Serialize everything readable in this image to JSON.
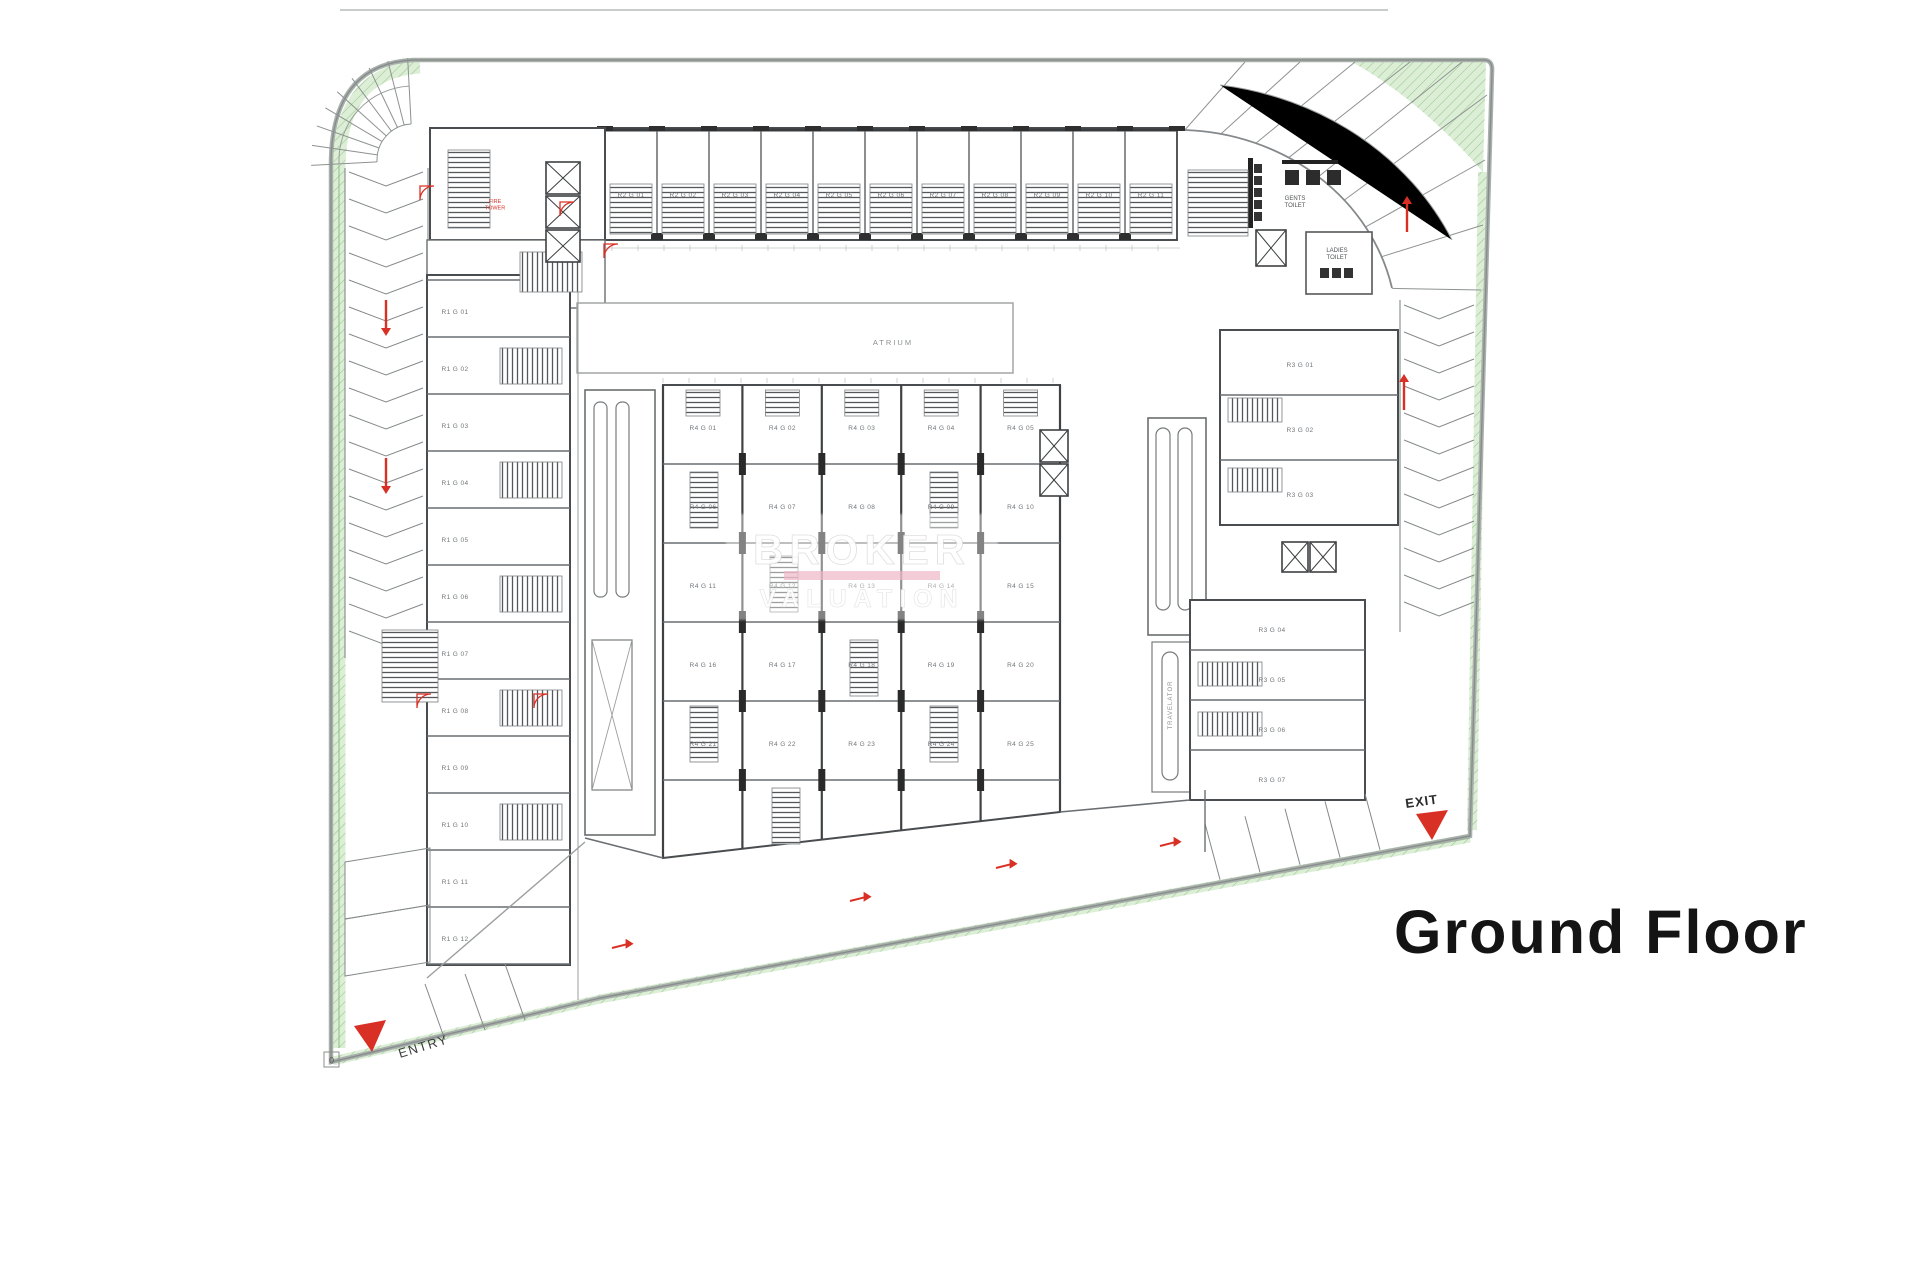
{
  "title": "Ground Floor",
  "labels": {
    "entry": "ENTRY",
    "exit": "EXIT",
    "atrium": "ATRIUM",
    "gents_toilet": "GENTS TOILET",
    "ladies_toilet": "LADIES TOILET",
    "fire_tower": "FIRE TOWER",
    "travelator": "TRAVELATOR",
    "origin_marker": "0"
  },
  "watermark": {
    "line1": "BROKER",
    "line2": "VALUATION"
  },
  "colors": {
    "green_fill": "#dcefd6",
    "green_line": "#8dbd84",
    "boundary": "#aab1ad",
    "boundary_dark": "#878d8a",
    "wall": "#4a4d4f",
    "red": "#d93025",
    "unit_text": "#71767a",
    "title_text": "#141414"
  },
  "units": {
    "top_row": [
      "R2 G 01",
      "R2 G 02",
      "R2 G 03",
      "R2 G 04",
      "R2 G 05",
      "R2 G 06",
      "R2 G 07",
      "R2 G 08",
      "R2 G 09",
      "R2 G 10",
      "R2 G 11"
    ],
    "left_column": [
      "R1 G 01",
      "R1 G 02",
      "R1 G 03",
      "R1 G 04",
      "R1 G 05",
      "R1 G 06",
      "R1 G 07",
      "R1 G 08",
      "R1 G 09",
      "R1 G 10",
      "R1 G 11",
      "R1 G 12"
    ],
    "right_upper": [
      "R3 G 01",
      "R3 G 02",
      "R3 G 03"
    ],
    "right_lower": [
      "R3 G 04",
      "R3 G 05",
      "R3 G 06",
      "R3 G 07"
    ],
    "center_grid": [
      "R4 G 01",
      "R4 G 02",
      "R4 G 03",
      "R4 G 04",
      "R4 G 05",
      "R4 G 06",
      "R4 G 07",
      "R4 G 08",
      "R4 G 09",
      "R4 G 10",
      "R4 G 11",
      "R4 G 12",
      "R4 G 13",
      "R4 G 14",
      "R4 G 15",
      "R4 G 16",
      "R4 G 17",
      "R4 G 18",
      "R4 G 19",
      "R4 G 20",
      "R4 G 21",
      "R4 G 22",
      "R4 G 23",
      "R4 G 24",
      "R4 G 25"
    ]
  }
}
